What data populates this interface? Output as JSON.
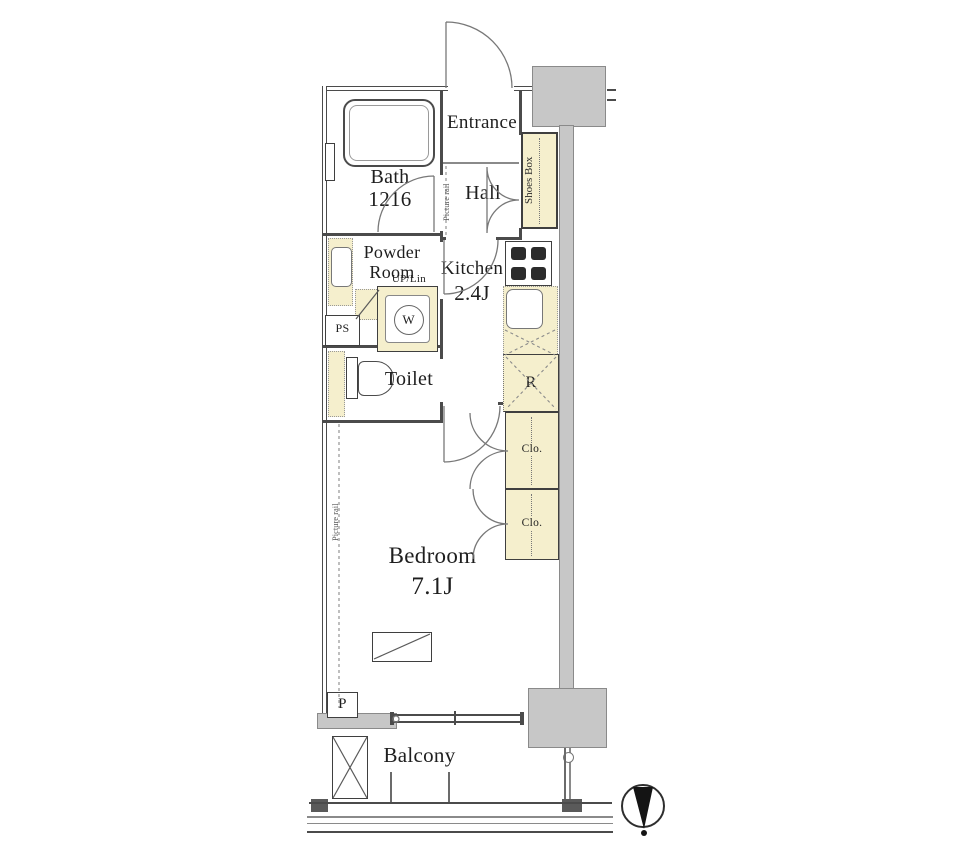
{
  "floorplan": {
    "rooms": {
      "entrance": {
        "label": "Entrance"
      },
      "hall": {
        "label": "Hall"
      },
      "bath": {
        "label": "Bath",
        "size": "1216"
      },
      "powder": {
        "line1": "Powder",
        "line2": "Room"
      },
      "kitchen": {
        "label": "Kitchen",
        "size": "2.4J"
      },
      "toilet": {
        "label": "Toilet"
      },
      "bedroom": {
        "label": "Bedroom",
        "size": "7.1J"
      },
      "balcony": {
        "label": "Balcony"
      }
    },
    "fixtures": {
      "shoes_box": "Shoes Box",
      "closet_upper": "Clo.",
      "closet_lower": "Clo.",
      "refrigerator": "R",
      "washer": "W",
      "pipe_space": "PS",
      "linen": "UP/Lin",
      "pole": "P"
    },
    "annotations": {
      "picture_rail_hall": "Picture rail",
      "picture_rail_bedroom": "Picture rail"
    },
    "colors": {
      "fixture_yellow": "#f5efcd",
      "wall_dark": "#4b4b4b",
      "column_gray": "#c7c7c7"
    }
  }
}
